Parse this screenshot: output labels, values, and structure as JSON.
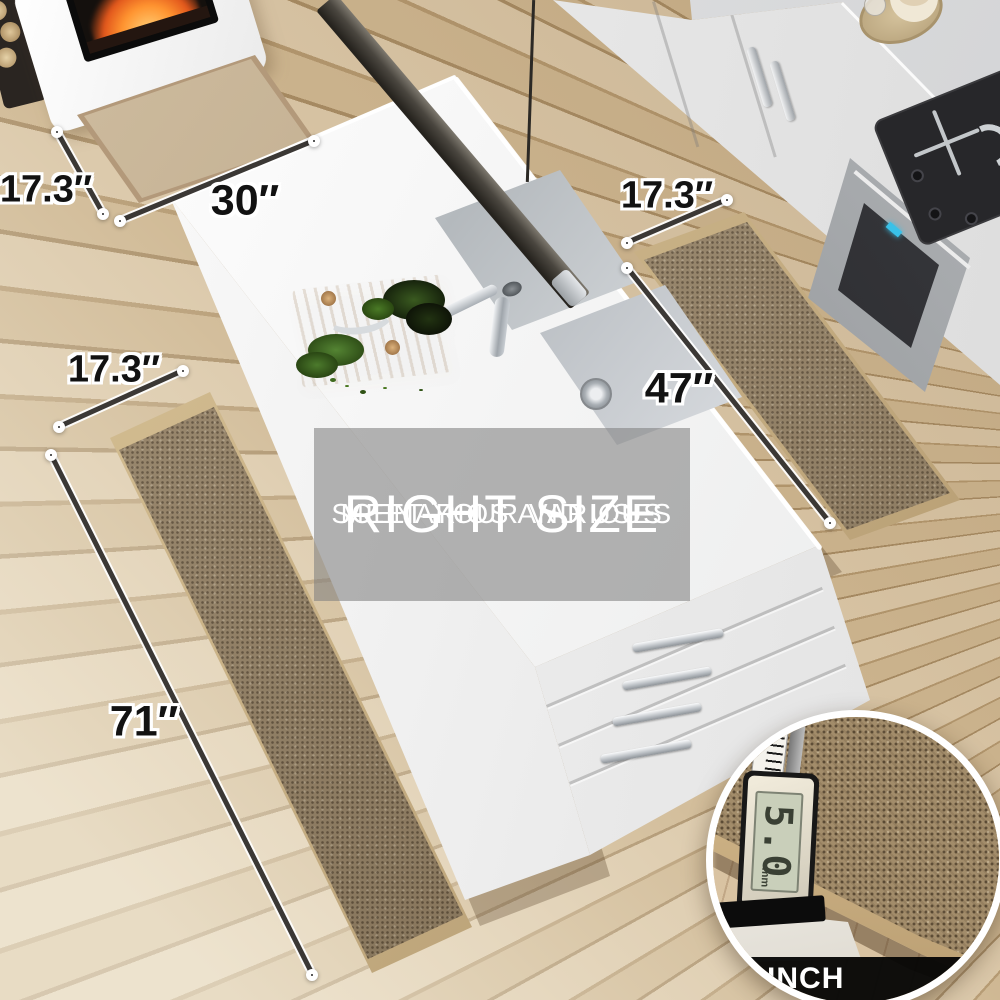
{
  "overlay": {
    "title": "RIGHT SIZE",
    "subtitle1": "MEET YOUR VARIOUS",
    "subtitle2": "SCENARIOS AND USES"
  },
  "dimensions": [
    {
      "id": "front-mat-width",
      "label": "17.3″"
    },
    {
      "id": "front-mat-length",
      "label": "30″"
    },
    {
      "id": "side-rug-width",
      "label": "17.3″"
    },
    {
      "id": "side-rug-length",
      "label": "47″"
    },
    {
      "id": "runner-width",
      "label": "17.3″"
    },
    {
      "id": "runner-length",
      "label": "71″"
    }
  ],
  "inset": {
    "caliper_reading": "5.0",
    "caliper_unit": "mm",
    "thickness_label": "0.2 INCH"
  },
  "colors": {
    "rug": "#97856a",
    "rug_binding": "#c8ad82",
    "floor": "#cfb692",
    "overlay_tint": "rgba(128,128,128,0.58)",
    "text_on_overlay": "#ffffff"
  }
}
